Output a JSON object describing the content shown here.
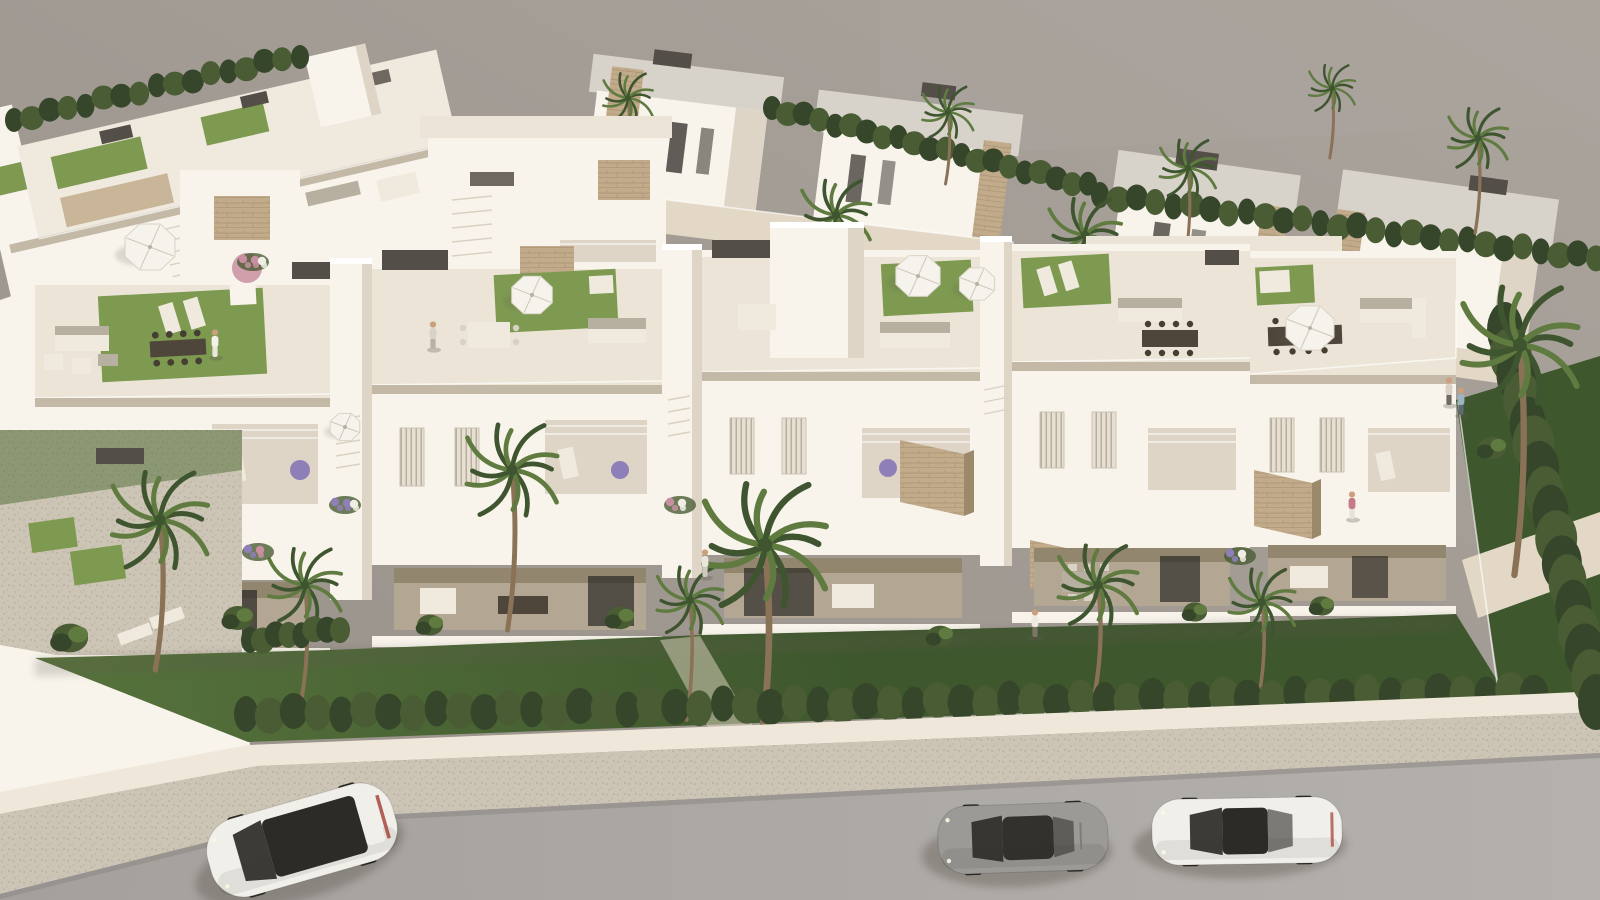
{
  "scene": {
    "type": "3d-architectural-render",
    "description": "Aerial daytime rendering of a white Mediterranean residential development: a front row of flat-roofed townhouses with furnished rooftop terraces and green roof lawns, balconies with stone-clad canopies, ground-floor terraces, front gardens with palm trees, a continuous clipped hedge along the street, a gravel sidewalk, and a gray road with three parked cars against a plain gray backdrop",
    "camera": "high oblique aerial",
    "visible_text": "none"
  },
  "palette": {
    "backdrop": "#97918a",
    "backdrop_light": "#aba49d",
    "wall_bright": "#f8f4ec",
    "wall_lit": "#efe9de",
    "wall_shade": "#ded5c7",
    "wall_deep": "#c4b9a6",
    "roof_floor": "#ece5d7",
    "roof_gray": "#d8d3ca",
    "stone": "#c2ab8b",
    "stone_dark": "#9c886a",
    "dark_box": "#534e48",
    "dark_box_lit": "#6e6861",
    "glass": "#2d2b27",
    "lawn_roof": "#7d9a50",
    "lawn_ground": "#57733c",
    "lawn_shadow": "#3e572d",
    "hedge": "#495c33",
    "hedge_dark": "#36462a",
    "palm_green": "#5f7b40",
    "palm_dark": "#3e5530",
    "trunk": "#8a7257",
    "path_beige": "#e3d8c5",
    "gravel": "#ccc4b5",
    "curb": "#efe8da",
    "road": "#a4a09d",
    "road_light": "#b4b0ac",
    "shadow": "#5e594f",
    "umbrella_white": "#f6f3ed",
    "umbrella_straw": "#c3a873",
    "flower_purple": "#8f7fb8",
    "flower_pink": "#c98fa0",
    "flower_white": "#f0ede4",
    "flower_orange": "#c8914f",
    "wood": "#6b5136",
    "wood_light": "#8a6f52",
    "furn_white": "#efeadd",
    "furn_gray": "#b7afa0",
    "table_dark": "#4e463a",
    "car_white": "#f1efe9",
    "car_gray": "#9b9a97",
    "wheel": "#2a2926",
    "tail_red": "#a23b32",
    "skin": "#caa07e"
  },
  "objects": {
    "cars": [
      {
        "name": "car-white-suv",
        "style": "suv",
        "x": 302,
        "y": 840,
        "rot": -16,
        "len": 192,
        "wid": 80,
        "body": "car_white"
      },
      {
        "name": "car-gray-coupe",
        "style": "coupe",
        "x": 1023,
        "y": 838,
        "rot": -2,
        "len": 170,
        "wid": 68,
        "body": "car_gray"
      },
      {
        "name": "car-white-sedan",
        "style": "sedan",
        "x": 1247,
        "y": 831,
        "rot": -1,
        "len": 190,
        "wid": 66,
        "body": "car_white"
      }
    ],
    "palms": [
      {
        "layer": "bg",
        "x": 628,
        "y": 98,
        "h": 70,
        "size": 30
      },
      {
        "layer": "bg",
        "x": 948,
        "y": 112,
        "h": 72,
        "size": 31
      },
      {
        "layer": "bg",
        "x": 1188,
        "y": 168,
        "h": 90,
        "size": 34
      },
      {
        "layer": "bg",
        "x": 1332,
        "y": 88,
        "h": 70,
        "size": 28
      },
      {
        "layer": "bg",
        "x": 1478,
        "y": 138,
        "h": 95,
        "size": 36
      },
      {
        "layer": "bg",
        "x": 836,
        "y": 215,
        "h": 120,
        "size": 42
      },
      {
        "layer": "bg",
        "x": 1085,
        "y": 235,
        "h": 115,
        "size": 44
      },
      {
        "layer": "fg",
        "x": 160,
        "y": 520,
        "h": 150,
        "size": 58
      },
      {
        "layer": "fg",
        "x": 305,
        "y": 585,
        "h": 115,
        "size": 44
      },
      {
        "layer": "fg",
        "x": 512,
        "y": 470,
        "h": 160,
        "size": 55
      },
      {
        "layer": "fg",
        "x": 690,
        "y": 600,
        "h": 120,
        "size": 40
      },
      {
        "layer": "fg",
        "x": 765,
        "y": 545,
        "h": 210,
        "size": 74
      },
      {
        "layer": "fg",
        "x": 1098,
        "y": 585,
        "h": 112,
        "size": 48
      },
      {
        "layer": "fg",
        "x": 1262,
        "y": 602,
        "h": 95,
        "size": 40
      },
      {
        "layer": "right",
        "x": 1520,
        "y": 345,
        "h": 230,
        "size": 70
      }
    ],
    "hedgerows": [
      {
        "layer": "front",
        "x0": 246,
        "y0": 714,
        "x1": 1534,
        "y1": 692,
        "n": 54,
        "rx": 12,
        "ry": 18
      },
      {
        "layer": "far",
        "x0": 14,
        "y0": 120,
        "x1": 300,
        "y1": 55,
        "n": 16,
        "rx": 9,
        "ry": 12
      },
      {
        "layer": "far",
        "x0": 772,
        "y0": 108,
        "x1": 1088,
        "y1": 186,
        "n": 20,
        "rx": 9,
        "ry": 12
      },
      {
        "layer": "far",
        "x0": 1100,
        "y0": 195,
        "x1": 1596,
        "y1": 258,
        "n": 27,
        "rx": 9,
        "ry": 13
      },
      {
        "layer": "right",
        "x0": 1505,
        "y0": 330,
        "x1": 1596,
        "y1": 700,
        "n": 16,
        "rx": 18,
        "ry": 28
      },
      {
        "layer": "front",
        "x0": 250,
        "y0": 640,
        "x1": 340,
        "y1": 628,
        "n": 7,
        "rx": 9,
        "ry": 13
      }
    ],
    "umbrellas": [
      {
        "type": "white",
        "x": 150,
        "y": 247,
        "r": 27
      },
      {
        "type": "white",
        "x": 532,
        "y": 295,
        "r": 22
      },
      {
        "type": "white",
        "x": 918,
        "y": 276,
        "r": 24
      },
      {
        "type": "white",
        "x": 977,
        "y": 284,
        "r": 19
      },
      {
        "type": "white",
        "x": 1310,
        "y": 328,
        "r": 26
      },
      {
        "type": "white",
        "x": 112,
        "y": 500,
        "r": 22
      },
      {
        "type": "white",
        "x": 345,
        "y": 427,
        "r": 16
      },
      {
        "type": "straw",
        "x": 88,
        "y": 582,
        "r": 27
      }
    ],
    "people": [
      {
        "x": 215,
        "y": 338,
        "shirt": "#f4f1ea",
        "pants": "#eae6da",
        "where": "rooftop-walker"
      },
      {
        "x": 433,
        "y": 330,
        "shirt": "#d8d3c8",
        "pants": "#b8b2a5",
        "where": "roof-lawn"
      },
      {
        "x": 705,
        "y": 558,
        "shirt": "#e9e5dc",
        "pants": "#cfc9bd",
        "where": "ground-terrace-center"
      },
      {
        "x": 1035,
        "y": 618,
        "shirt": "#edebe0",
        "pants": "#7d7668",
        "where": "ground-terrace-right"
      },
      {
        "x": 1449,
        "y": 386,
        "shirt": "#d9cfc2",
        "pants": "#6f6a61",
        "where": "roof-deck-rail"
      },
      {
        "x": 1461,
        "y": 396,
        "shirt": "#9db3c0",
        "pants": "#5d6a72",
        "where": "roof-deck-rail"
      },
      {
        "x": 1352,
        "y": 500,
        "shirt": "#c7798a",
        "pants": "#e6e2d8",
        "where": "balcony"
      }
    ],
    "flowerbeds": [
      {
        "layer": "far",
        "x": 700,
        "y": 300,
        "colors": [
          "flower_purple",
          "flower_white"
        ]
      },
      {
        "layer": "far",
        "x": 760,
        "y": 322,
        "colors": [
          "flower_orange",
          "flower_white"
        ]
      },
      {
        "layer": "far",
        "x": 880,
        "y": 330,
        "colors": [
          "flower_purple",
          "flower_pink"
        ]
      },
      {
        "layer": "far",
        "x": 1150,
        "y": 310,
        "colors": [
          "flower_pink",
          "flower_white"
        ]
      },
      {
        "layer": "front",
        "x": 345,
        "y": 505,
        "colors": [
          "flower_purple",
          "flower_purple",
          "flower_white"
        ]
      },
      {
        "layer": "front",
        "x": 258,
        "y": 552,
        "colors": [
          "flower_purple",
          "flower_pink"
        ]
      },
      {
        "layer": "front",
        "x": 680,
        "y": 505,
        "colors": [
          "flower_pink",
          "flower_white"
        ]
      },
      {
        "layer": "front",
        "x": 1240,
        "y": 556,
        "colors": [
          "flower_purple",
          "flower_white"
        ]
      },
      {
        "layer": "front",
        "x": 253,
        "y": 262,
        "colors": [
          "flower_pink",
          "flower_pink",
          "flower_white"
        ]
      }
    ],
    "shrubs": [
      {
        "layer": "front",
        "x": 70,
        "y": 638,
        "r": 18
      },
      {
        "layer": "front",
        "x": 238,
        "y": 618,
        "r": 15
      },
      {
        "layer": "front",
        "x": 430,
        "y": 625,
        "r": 13
      },
      {
        "layer": "front",
        "x": 620,
        "y": 618,
        "r": 14
      },
      {
        "layer": "front",
        "x": 940,
        "y": 636,
        "r": 13
      },
      {
        "layer": "front",
        "x": 1195,
        "y": 612,
        "r": 12
      },
      {
        "layer": "front",
        "x": 1322,
        "y": 606,
        "r": 12
      },
      {
        "layer": "right",
        "x": 1492,
        "y": 448,
        "r": 14
      },
      {
        "layer": "far",
        "x": 600,
        "y": 250,
        "r": 12
      },
      {
        "layer": "far",
        "x": 660,
        "y": 280,
        "r": 14
      }
    ],
    "counts": {
      "cars": 3,
      "townhouse-units": 5,
      "people": 7,
      "front-palms": 8,
      "umbrellas": 8
    }
  }
}
